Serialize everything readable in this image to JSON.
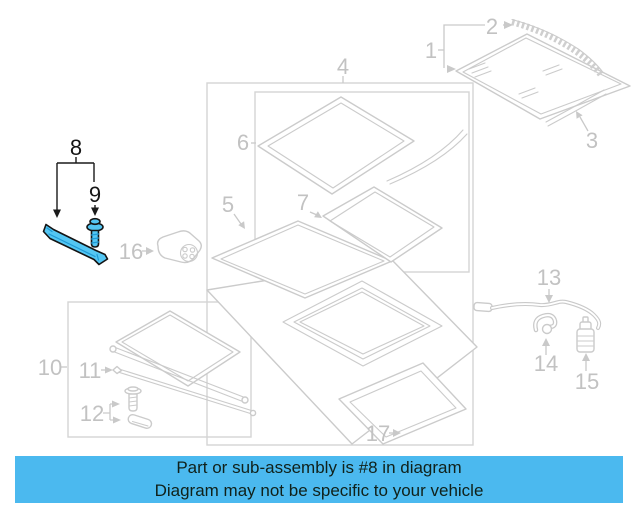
{
  "callouts": {
    "1": "1",
    "2": "2",
    "3": "3",
    "4": "4",
    "5": "5",
    "6": "6",
    "7": "7",
    "8": "8",
    "9": "9",
    "10": "10",
    "11": "11",
    "12": "12",
    "13": "13",
    "14": "14",
    "15": "15",
    "16": "16",
    "17": "17"
  },
  "highlight": {
    "part_number": "8",
    "fill": "#53c6f3",
    "outline": "#141414"
  },
  "banner": {
    "line1": "Part or sub-assembly is #8 in diagram",
    "line2": "Diagram may not be specific to your vehicle",
    "bg": "#4bb9ef",
    "text_color": "#10211a"
  },
  "colors": {
    "diagram_line": "#cbcbcb",
    "diagram_label": "#c2c2c2",
    "box_line": "#d4d4d4"
  }
}
